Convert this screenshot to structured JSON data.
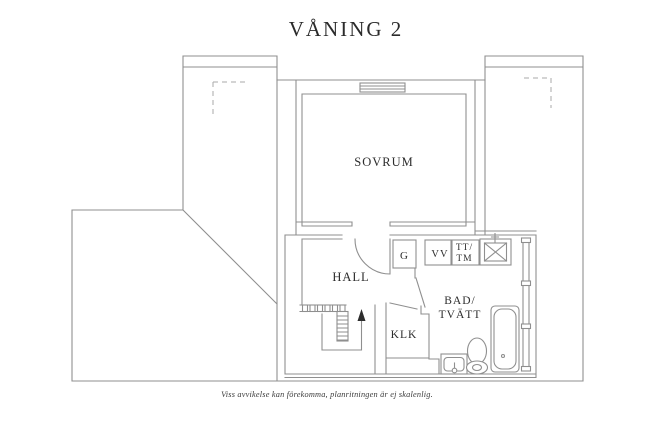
{
  "title": "VÅNING 2",
  "disclaimer": "Viss avvikelse kan förekomma, planritningen är ej skalenlig.",
  "labels": {
    "sovrum": "SOVRUM",
    "hall": "HALL",
    "klk": "KLK",
    "bad_line1": "BAD/",
    "bad_line2": "TVÄTT",
    "garderob": "G",
    "vv": "VV",
    "tt_line1": "TT/",
    "tt_line2": "TM"
  },
  "colors": {
    "wall": "#8f8f8f",
    "dashed_line": "#aaaaaa",
    "text": "#2d2d2d",
    "background": "#ffffff"
  }
}
